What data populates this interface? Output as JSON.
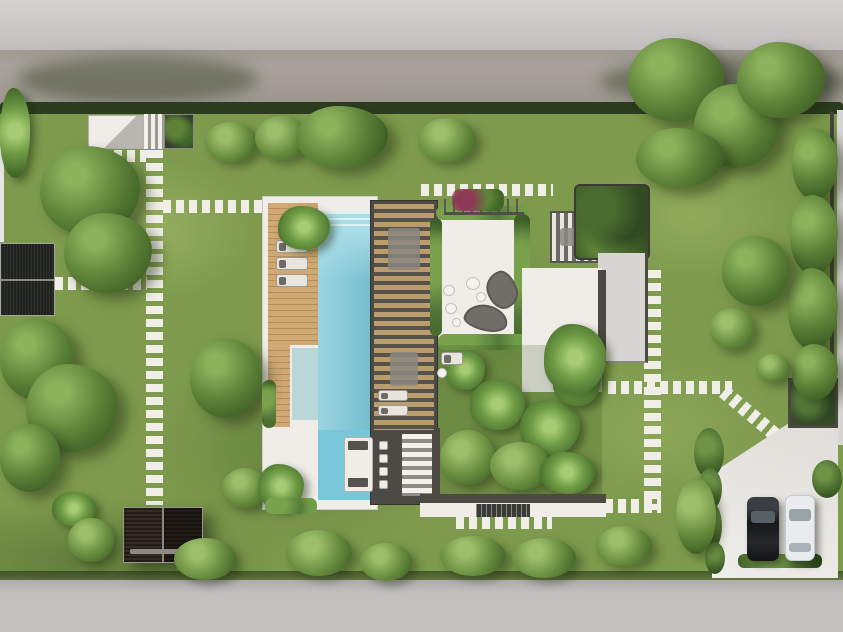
{
  "scene": {
    "type": "aerial-architectural-rendering",
    "description": "Top-down 3D site plan rendering of a modern villa: street and sidewalk at top, fenced green garden with stepping-stone paths, L-shaped swimming pool with wooden sun deck and slatted pergola, white roof terrace with organic lounge furniture, tropical courtyard garden, two detached dark pergolas, and a driveway at bottom right with two parked cars on a second street.",
    "text_content": "none (image contains no readable text)"
  },
  "palette": {
    "sidewalk": "#c7c4c3",
    "road_top": "#a8a29a",
    "road_bottom": "#c2bfbe",
    "lawn": "#7d9a4d",
    "hedge": "#2b3d1e",
    "tree_dark": "#33521e",
    "tree_mid": "#5d8238",
    "tree_light": "#8cb25c",
    "pool_water": "#79c6d8",
    "pool_shallow": "#b9d6d8",
    "deck_wood": "#c8a06c",
    "pergola_frame": "#4b4a45",
    "pergola_slat_wood": "#bb9c6c",
    "white_surface": "#f0ede8",
    "roof_gray": "#d7d5d1",
    "stepping_stone": "#f0eee7",
    "dark_structure": "#20231d",
    "dark_wood_pergola": "#352c24",
    "driveway": "#ebe9e4",
    "car_black": "#1a1b1e",
    "car_white": "#e9ecee",
    "wall_dark": "#4b4941",
    "edge_sliver": "#d8d6d3"
  },
  "objects": {
    "streets": [
      "top sidewalk",
      "top road with tree shadows",
      "bottom road"
    ],
    "house": [
      "wooden sun deck with three loungers",
      "L-shaped swimming pool with steps",
      "shallow reflecting pool",
      "slatted pergola roof over dining area",
      "outdoor kitchen bar with four stools",
      "white roof terrace with two kidney-shaped sofas and poufs",
      "flower planter with railing",
      "vertical-slat pergola wing",
      "green roof garden",
      "gray flat roof",
      "white lower patio with palm"
    ],
    "garden": [
      "stepping stone paths (left vertical, branches to pergola and pool, top path, right vertical, diagonal to driveway)",
      "tropical courtyard with palms",
      "garden stair inset in white walkway",
      "many trees and round bushes",
      "perimeter hedges and right fence"
    ],
    "outbuildings": [
      "top-left entry structure with steps and planter",
      "left dark carport pergola",
      "bottom-left dark wood pergola with bench",
      "driveway gate structure"
    ],
    "vehicles": [
      "black car",
      "white car"
    ]
  }
}
